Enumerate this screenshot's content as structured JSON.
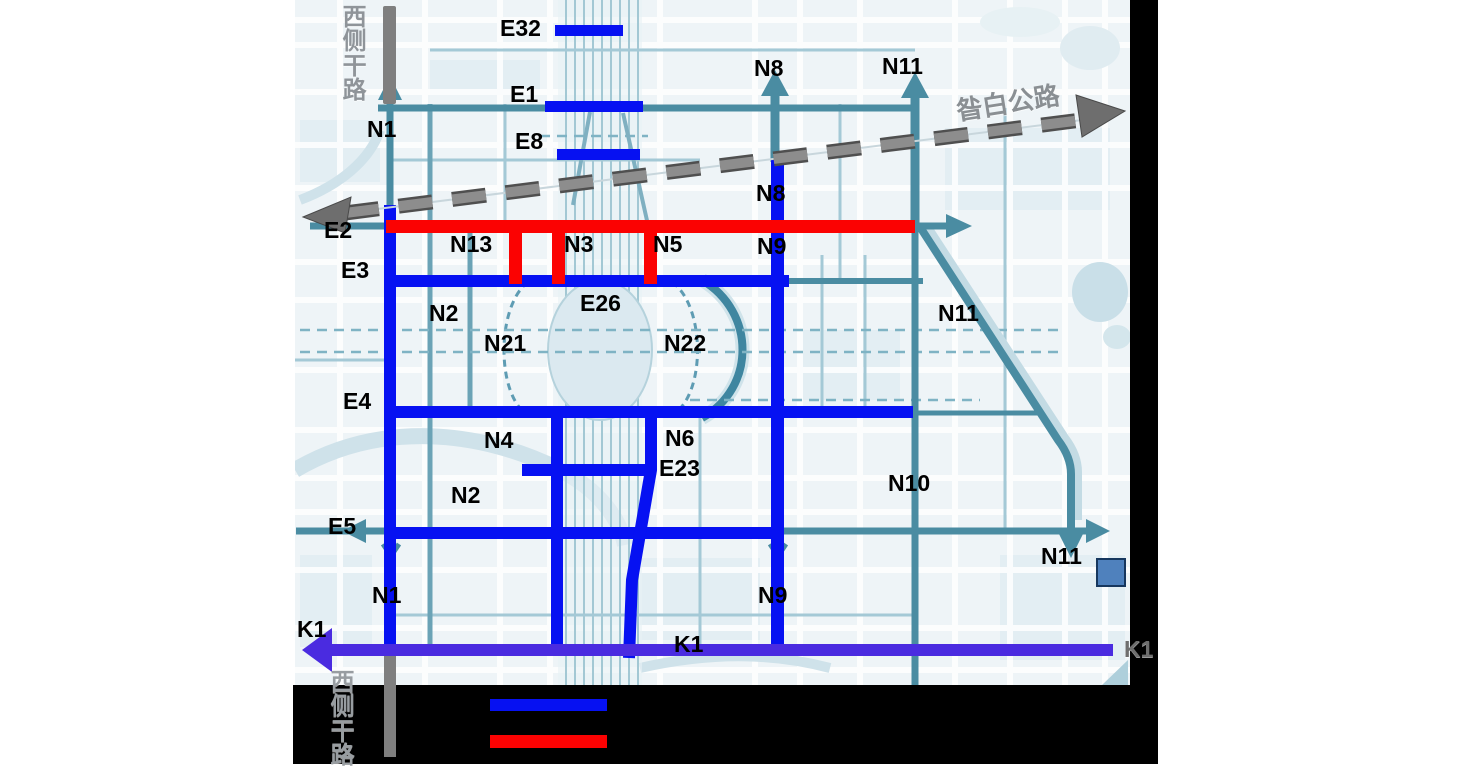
{
  "map_labels": [
    {
      "text": "西侧干路",
      "x": 342,
      "y": 6,
      "vertical": true,
      "color": "#8f9499",
      "size": 24,
      "name": "west-side-road-label-top"
    },
    {
      "text": "E32",
      "x": 500,
      "y": 17,
      "name": "road-label-E32"
    },
    {
      "text": "E1",
      "x": 510,
      "y": 83,
      "name": "road-label-E1"
    },
    {
      "text": "E8",
      "x": 515,
      "y": 130,
      "name": "road-label-E8"
    },
    {
      "text": "N1",
      "x": 367,
      "y": 118,
      "name": "road-label-N1-top"
    },
    {
      "text": "N8",
      "x": 754,
      "y": 57,
      "name": "road-label-N8-top"
    },
    {
      "text": "N11",
      "x": 882,
      "y": 55,
      "name": "road-label-N11-top"
    },
    {
      "text": "昝白公路",
      "x": 956,
      "y": 90,
      "rot": -9,
      "color": "#8a8f93",
      "size": 26,
      "name": "zanbai-highway-label"
    },
    {
      "text": "E2",
      "x": 324,
      "y": 219,
      "name": "road-label-E2"
    },
    {
      "text": "N8",
      "x": 756,
      "y": 182,
      "name": "road-label-N8-mid"
    },
    {
      "text": "N13",
      "x": 450,
      "y": 233,
      "name": "road-label-N13"
    },
    {
      "text": "N3",
      "x": 564,
      "y": 233,
      "name": "road-label-N3"
    },
    {
      "text": "N5",
      "x": 653,
      "y": 233,
      "name": "road-label-N5"
    },
    {
      "text": "N9",
      "x": 757,
      "y": 235,
      "name": "road-label-N9-mid"
    },
    {
      "text": "E3",
      "x": 341,
      "y": 259,
      "name": "road-label-E3"
    },
    {
      "text": "N2",
      "x": 429,
      "y": 302,
      "name": "road-label-N2-upper"
    },
    {
      "text": "E26",
      "x": 580,
      "y": 292,
      "name": "road-label-E26"
    },
    {
      "text": "N21",
      "x": 484,
      "y": 332,
      "name": "road-label-N21"
    },
    {
      "text": "N22",
      "x": 664,
      "y": 332,
      "name": "road-label-N22"
    },
    {
      "text": "N11",
      "x": 938,
      "y": 302,
      "name": "road-label-N11-mid"
    },
    {
      "text": "E4",
      "x": 343,
      "y": 390,
      "name": "road-label-E4"
    },
    {
      "text": "N4",
      "x": 484,
      "y": 429,
      "name": "road-label-N4"
    },
    {
      "text": "N6",
      "x": 665,
      "y": 427,
      "name": "road-label-N6"
    },
    {
      "text": "E23",
      "x": 659,
      "y": 457,
      "name": "road-label-E23"
    },
    {
      "text": "N2",
      "x": 451,
      "y": 484,
      "name": "road-label-N2-lower"
    },
    {
      "text": "N10",
      "x": 888,
      "y": 472,
      "name": "road-label-N10"
    },
    {
      "text": "E5",
      "x": 328,
      "y": 515,
      "name": "road-label-E5"
    },
    {
      "text": "N11",
      "x": 1041,
      "y": 545,
      "name": "road-label-N11-low"
    },
    {
      "text": "N1",
      "x": 372,
      "y": 584,
      "name": "road-label-N1-low"
    },
    {
      "text": "N9",
      "x": 758,
      "y": 584,
      "name": "road-label-N9-low"
    },
    {
      "text": "K1",
      "x": 297,
      "y": 618,
      "name": "road-label-K1-left"
    },
    {
      "text": "K1",
      "x": 674,
      "y": 633,
      "name": "road-label-K1-mid"
    },
    {
      "text": "K1",
      "x": 1124,
      "y": 638,
      "color": "#6e6e6e",
      "name": "road-label-K1-right"
    },
    {
      "text": "西侧干路",
      "x": 330,
      "y": 671,
      "vertical": true,
      "color": "#989da1",
      "size": 24,
      "name": "west-side-road-label-bottom"
    }
  ],
  "legend": {
    "items": [
      {
        "color": "#0611f2"
      },
      {
        "color": "#fb0202"
      }
    ]
  },
  "colors": {
    "blue_road": "#0611f2",
    "red_road": "#fb0202",
    "teal_road": "#4a8ca2",
    "k1_road": "#4a2be0",
    "dashed_highway_gray": "#7d7d7d",
    "gray_road_bar": "#7f7f7f",
    "marker_square_fill": "#4f81bd",
    "marker_square_border": "#17375e"
  }
}
